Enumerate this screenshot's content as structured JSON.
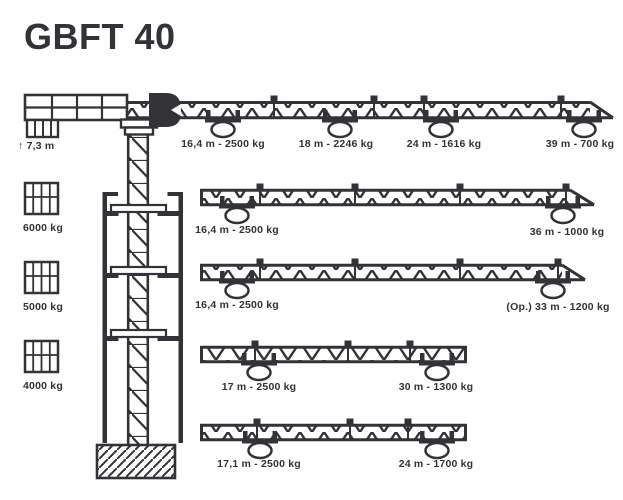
{
  "title": "GBFT 40",
  "colors": {
    "ink": "#333337",
    "background": "#ffffff"
  },
  "counter_jib_label": "↑ 7,3 m",
  "counterweights": [
    "6000 kg",
    "5000 kg",
    "4000 kg"
  ],
  "jib_configurations": [
    {
      "capacities": [
        "16,4 m - 2500 kg",
        "18 m - 2246 kg",
        "24 m - 1616 kg",
        "39 m - 700 kg"
      ]
    },
    {
      "capacities": [
        "16,4 m - 2500 kg",
        "36 m - 1000 kg"
      ]
    },
    {
      "capacities": [
        "16,4 m - 2500 kg",
        "(Op.) 33 m - 1200 kg"
      ]
    },
    {
      "capacities": [
        "17 m - 2500 kg",
        "30 m - 1300 kg"
      ]
    },
    {
      "capacities": [
        "17,1 m - 2500 kg",
        "24 m - 1700 kg"
      ]
    }
  ]
}
